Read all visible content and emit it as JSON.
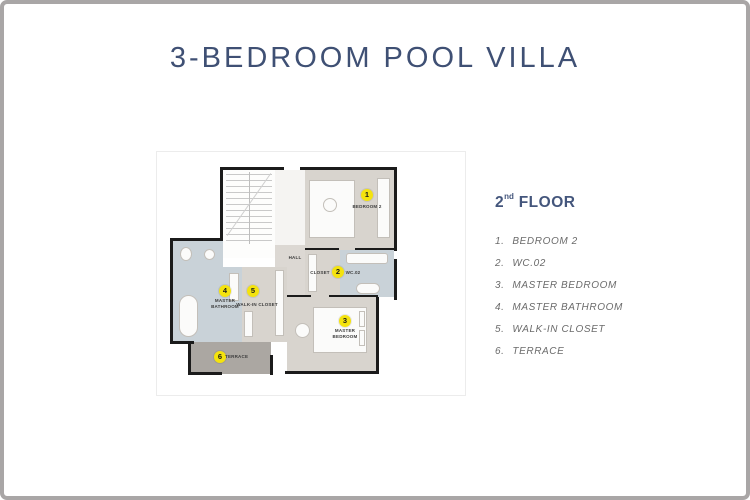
{
  "page": {
    "title": "3-BEDROOM POOL VILLA"
  },
  "legend": {
    "heading": {
      "number": "2",
      "suffix": "nd",
      "word": " FLOOR"
    },
    "items": [
      {
        "num": "1.",
        "label": "BEDROOM 2"
      },
      {
        "num": "2.",
        "label": "WC.02"
      },
      {
        "num": "3.",
        "label": "MASTER BEDROOM"
      },
      {
        "num": "4.",
        "label": "MASTER BATHROOM"
      },
      {
        "num": "5.",
        "label": "WALK-IN CLOSET"
      },
      {
        "num": "6.",
        "label": "TERRACE"
      }
    ]
  },
  "plan": {
    "markers": [
      "1",
      "2",
      "3",
      "4",
      "5",
      "6"
    ],
    "labels": {
      "bedroom2": "BEDROOM 2",
      "hall": "HALL",
      "closet": "CLOSET",
      "wc": "WC.02",
      "master_bathroom": "MASTER BATHROOM",
      "walk_in_closet": "WALK-IN CLOSET",
      "master_bedroom": "MASTER BEDROOM",
      "terrace": "TERRACE"
    }
  },
  "colors": {
    "accent_blue": "#44567C",
    "marker_yellow": "#F4E30E",
    "room_beige": "#D8D4CE",
    "bath_blue_grey": "#C9D2D8",
    "terrace_grey": "#ABA7A2",
    "frame_grey": "#A9A6A6",
    "wall_black": "#1B1B1B"
  }
}
